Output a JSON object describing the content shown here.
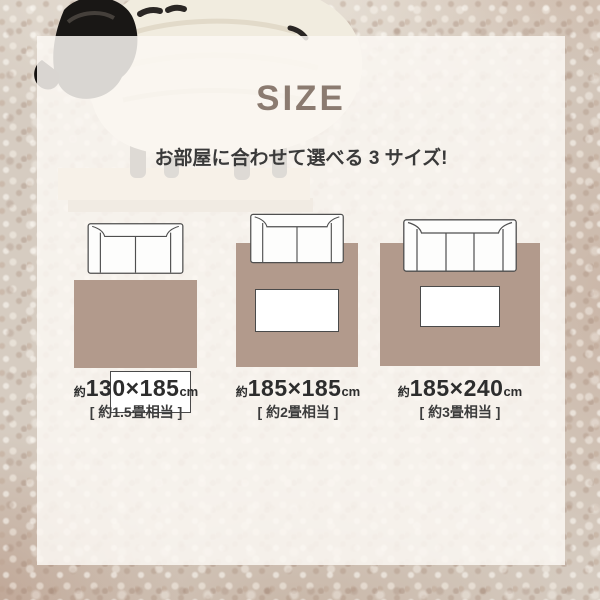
{
  "header": {
    "title": "SIZE",
    "subtitle": "お部屋に合わせて選べる 3 サイズ!"
  },
  "sizes": [
    {
      "approx": "約",
      "dimensions": "130×185",
      "unit": "cm",
      "tatami_note": "[ 約1.5畳相当 ]",
      "sofa_seats": 2
    },
    {
      "approx": "約",
      "dimensions": "185×185",
      "unit": "cm",
      "tatami_note": "[ 約2畳相当 ]",
      "sofa_seats": 2
    },
    {
      "approx": "約",
      "dimensions": "185×240",
      "unit": "cm",
      "tatami_note": "[ 約3畳相当 ]",
      "sofa_seats": 3
    }
  ],
  "colors": {
    "rug": "#b29a8c",
    "title": "#8b7b70",
    "text": "#333333",
    "sofa_outline": "#4f4f4f",
    "panel": "rgba(251,248,243,0.85)"
  }
}
